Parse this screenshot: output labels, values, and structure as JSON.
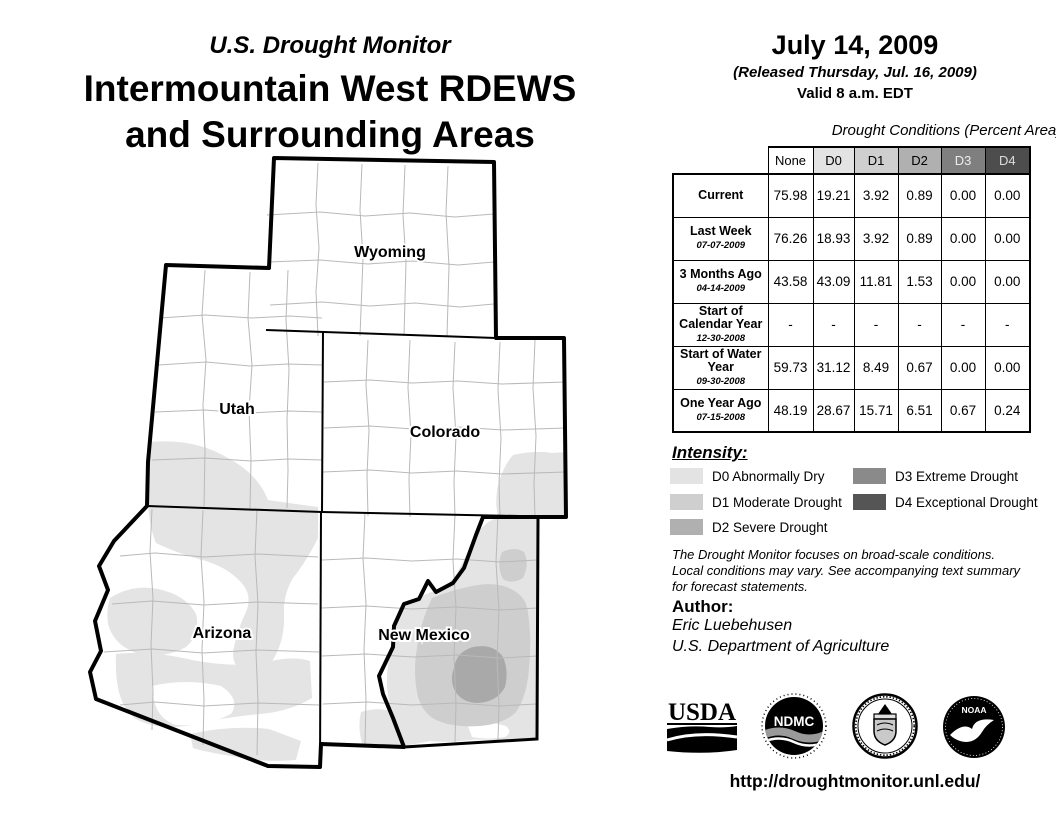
{
  "header": {
    "kicker": "U.S. Drought Monitor",
    "title_line1": "Intermountain West RDEWS",
    "title_line2": "and Surrounding Areas"
  },
  "date_block": {
    "date": "July 14, 2009",
    "released": "(Released Thursday, Jul. 16, 2009)",
    "valid": "Valid 8 a.m. EDT"
  },
  "table": {
    "caption": "Drought Conditions (Percent Area)",
    "columns": [
      "None",
      "D0",
      "D1",
      "D2",
      "D3",
      "D4"
    ],
    "rows": [
      {
        "label": "Current",
        "date": "",
        "values": [
          "75.98",
          "19.21",
          "3.92",
          "0.89",
          "0.00",
          "0.00"
        ]
      },
      {
        "label": "Last Week",
        "date": "07-07-2009",
        "values": [
          "76.26",
          "18.93",
          "3.92",
          "0.89",
          "0.00",
          "0.00"
        ]
      },
      {
        "label": "3 Months Ago",
        "date": "04-14-2009",
        "values": [
          "43.58",
          "43.09",
          "11.81",
          "1.53",
          "0.00",
          "0.00"
        ]
      },
      {
        "label": "Start of Calendar Year",
        "date": "12-30-2008",
        "values": [
          "-",
          "-",
          "-",
          "-",
          "-",
          "-"
        ]
      },
      {
        "label": "Start of Water Year",
        "date": "09-30-2008",
        "values": [
          "59.73",
          "31.12",
          "8.49",
          "0.67",
          "0.00",
          "0.00"
        ]
      },
      {
        "label": "One Year Ago",
        "date": "07-15-2008",
        "values": [
          "48.19",
          "28.67",
          "15.71",
          "6.51",
          "0.67",
          "0.24"
        ]
      }
    ]
  },
  "legend": {
    "heading": "Intensity:",
    "items": [
      {
        "code": "D0",
        "label": "D0 Abnormally Dry",
        "color": "#e3e3e3"
      },
      {
        "code": "D1",
        "label": "D1 Moderate Drought",
        "color": "#cfcfcf"
      },
      {
        "code": "D2",
        "label": "D2 Severe Drought",
        "color": "#b0b0b0"
      },
      {
        "code": "D3",
        "label": "D3 Extreme Drought",
        "color": "#8a8a8a"
      },
      {
        "code": "D4",
        "label": "D4 Exceptional Drought",
        "color": "#555555"
      }
    ]
  },
  "disclaimer": {
    "line1": "The Drought Monitor focuses on broad-scale conditions.",
    "line2": "Local conditions may vary. See accompanying text summary",
    "line3": "for forecast statements."
  },
  "author": {
    "heading": "Author:",
    "name": "Eric Luebehusen",
    "org": "U.S. Department of Agriculture"
  },
  "footer": {
    "url": "http://droughtmonitor.unl.edu/"
  },
  "logos": {
    "usda": "USDA",
    "ndmc": "NDMC",
    "noaa": "NOAA"
  },
  "map": {
    "states": [
      {
        "name": "Wyoming"
      },
      {
        "name": "Utah"
      },
      {
        "name": "Colorado"
      },
      {
        "name": "Arizona"
      },
      {
        "name": "New Mexico"
      }
    ]
  },
  "colors": {
    "d0": "#e3e3e3",
    "d1": "#cfcfcf",
    "d2": "#b0b0b0",
    "d3": "#7f7f7f",
    "d4": "#4d4d4d",
    "county_line": "#b9b9b9",
    "border": "#000000"
  }
}
